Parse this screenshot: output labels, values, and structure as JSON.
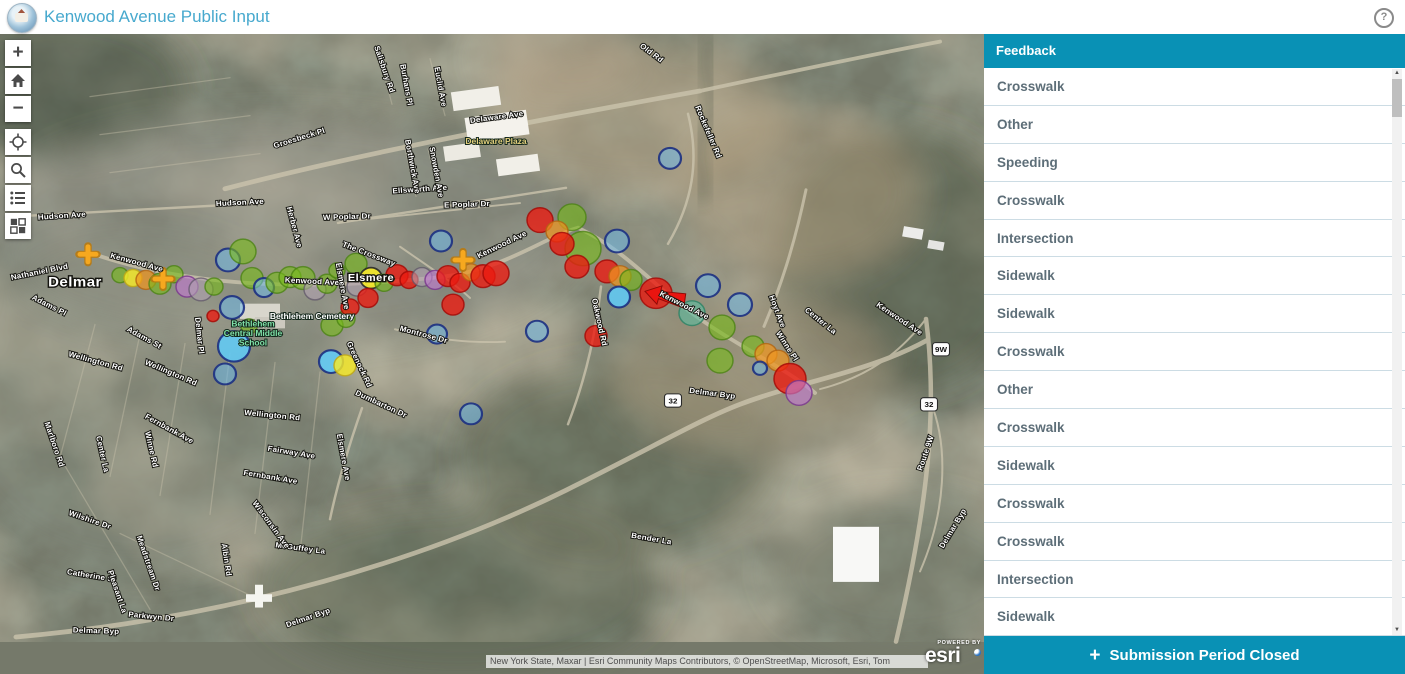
{
  "header": {
    "title": "Kenwood Avenue Public Input",
    "help": "?"
  },
  "panel": {
    "title": "Feedback",
    "items": [
      "Crosswalk",
      "Other",
      "Speeding",
      "Crosswalk",
      "Intersection",
      "Sidewalk",
      "Sidewalk",
      "Crosswalk",
      "Other",
      "Crosswalk",
      "Sidewalk",
      "Crosswalk",
      "Crosswalk",
      "Intersection",
      "Sidewalk"
    ],
    "footer_plus": "+",
    "footer_label": "Submission Period Closed"
  },
  "map": {
    "attribution": "New York State, Maxar | Esri Community Maps Contributors, © OpenStreetMap, Microsoft, Esri, Tom",
    "powered_by": "POWERED BY",
    "logo_text": "esri",
    "zoom_in_glyph": "+",
    "zoom_out_glyph": "−",
    "controls": [
      "zoom-in",
      "home",
      "zoom-out",
      "locate",
      "search",
      "legend",
      "basemap-gallery"
    ],
    "town_labels": [
      {
        "t": "Delmar",
        "x": 75,
        "y": 300
      },
      {
        "t": "Elsmere",
        "x": 371,
        "y": 294,
        "small": true
      }
    ],
    "poi_labels": [
      {
        "t": "Delaware Plaza",
        "x": 496,
        "y": 150,
        "c": "#e3cf7d"
      },
      {
        "t": "Bethlehem Cemetery",
        "x": 312,
        "y": 334,
        "c": "#ffffff"
      },
      {
        "t": "Bethlehem",
        "x": 253,
        "y": 342,
        "c": "#7fe0a8"
      },
      {
        "t": "Central Middle",
        "x": 253,
        "y": 352,
        "c": "#7fe0a8"
      },
      {
        "t": "School",
        "x": 253,
        "y": 362,
        "c": "#7fe0a8"
      }
    ],
    "road_labels": [
      {
        "t": "Hudson Ave",
        "x": 62,
        "y": 228,
        "r": -4
      },
      {
        "t": "Hudson Ave",
        "x": 240,
        "y": 214,
        "r": -3
      },
      {
        "t": "Nathaniel Blvd",
        "x": 40,
        "y": 287,
        "r": -12
      },
      {
        "t": "Kenwood Ave",
        "x": 136,
        "y": 277,
        "r": 16
      },
      {
        "t": "Kenwood Ave",
        "x": 312,
        "y": 297,
        "r": 3
      },
      {
        "t": "Kenwood Ave",
        "x": 503,
        "y": 258,
        "r": -27
      },
      {
        "t": "Kenwood Ave",
        "x": 683,
        "y": 322,
        "r": 28
      },
      {
        "t": "Kenwood Ave",
        "x": 898,
        "y": 336,
        "r": 35
      },
      {
        "t": "Delaware Ave",
        "x": 497,
        "y": 124,
        "r": -8
      },
      {
        "t": "Old Rd",
        "x": 650,
        "y": 56,
        "r": 38
      },
      {
        "t": "Rockefeller Rd",
        "x": 706,
        "y": 138,
        "r": 68
      },
      {
        "t": "Ellsworth Ave",
        "x": 420,
        "y": 200,
        "r": -4
      },
      {
        "t": "E Poplar Dr",
        "x": 467,
        "y": 216,
        "r": -2
      },
      {
        "t": "W Poplar Dr",
        "x": 347,
        "y": 229,
        "r": -2
      },
      {
        "t": "Euclid Ave",
        "x": 438,
        "y": 90,
        "r": 80
      },
      {
        "t": "Salisbury Rd",
        "x": 382,
        "y": 72,
        "r": 72
      },
      {
        "t": "Burhans Pl",
        "x": 404,
        "y": 88,
        "r": 80
      },
      {
        "t": "Groesbeck Pl",
        "x": 300,
        "y": 146,
        "r": -18
      },
      {
        "t": "Snowden Ave",
        "x": 434,
        "y": 180,
        "r": 80
      },
      {
        "t": "Borthwick Ave",
        "x": 410,
        "y": 174,
        "r": 80
      },
      {
        "t": "Herber Ave",
        "x": 292,
        "y": 238,
        "r": 76
      },
      {
        "t": "The Crossway",
        "x": 368,
        "y": 268,
        "r": 22
      },
      {
        "t": "Elsmere Ave",
        "x": 340,
        "y": 300,
        "r": 80
      },
      {
        "t": "Delmar Pl",
        "x": 197,
        "y": 352,
        "r": 84
      },
      {
        "t": "Adams Pl",
        "x": 48,
        "y": 322,
        "r": 28
      },
      {
        "t": "Adams St",
        "x": 143,
        "y": 356,
        "r": 30
      },
      {
        "t": "Wellington Rd",
        "x": 95,
        "y": 381,
        "r": 16
      },
      {
        "t": "Wellington Rd",
        "x": 170,
        "y": 393,
        "r": 24
      },
      {
        "t": "Wellington Rd",
        "x": 272,
        "y": 438,
        "r": 6
      },
      {
        "t": "Montrose Dr",
        "x": 423,
        "y": 353,
        "r": 16
      },
      {
        "t": "Greenock Rd",
        "x": 357,
        "y": 383,
        "r": 66
      },
      {
        "t": "Dumbarton Dr",
        "x": 380,
        "y": 426,
        "r": 26
      },
      {
        "t": "Oakwood Rd",
        "x": 597,
        "y": 338,
        "r": 78
      },
      {
        "t": "Fairway Ave",
        "x": 291,
        "y": 477,
        "r": 10
      },
      {
        "t": "Fernbank Ave",
        "x": 168,
        "y": 452,
        "r": 30
      },
      {
        "t": "Fernbank Ave",
        "x": 270,
        "y": 503,
        "r": 10
      },
      {
        "t": "Elsmere Ave",
        "x": 341,
        "y": 480,
        "r": 80
      },
      {
        "t": "Winne Rd",
        "x": 149,
        "y": 472,
        "r": 78
      },
      {
        "t": "Center La",
        "x": 100,
        "y": 477,
        "r": 78
      },
      {
        "t": "Marlboro Rd",
        "x": 52,
        "y": 467,
        "r": 72
      },
      {
        "t": "Wilshire Dr",
        "x": 89,
        "y": 548,
        "r": 20
      },
      {
        "t": "Catherine St",
        "x": 91,
        "y": 607,
        "r": 10
      },
      {
        "t": "Pleasant La",
        "x": 115,
        "y": 622,
        "r": 72
      },
      {
        "t": "Meadstream Dr",
        "x": 146,
        "y": 592,
        "r": 72
      },
      {
        "t": "Parkwyn Dr",
        "x": 151,
        "y": 650,
        "r": 6
      },
      {
        "t": "Albin Rd",
        "x": 224,
        "y": 588,
        "r": 82
      },
      {
        "t": "McGuffey La",
        "x": 300,
        "y": 578,
        "r": 8
      },
      {
        "t": "Wisconsin Ave",
        "x": 269,
        "y": 552,
        "r": 55
      },
      {
        "t": "Hoyt Ave",
        "x": 775,
        "y": 327,
        "r": 70
      },
      {
        "t": "Winne Pl",
        "x": 785,
        "y": 364,
        "r": 58
      },
      {
        "t": "Center La",
        "x": 819,
        "y": 338,
        "r": 40
      },
      {
        "t": "Bender La",
        "x": 651,
        "y": 568,
        "r": 10
      },
      {
        "t": "Delmar Byp",
        "x": 712,
        "y": 415,
        "r": 8
      },
      {
        "t": "Delmar Byp",
        "x": 96,
        "y": 665,
        "r": 2
      },
      {
        "t": "Delmar Byp",
        "x": 309,
        "y": 651,
        "r": -20
      },
      {
        "t": "Route 9W",
        "x": 928,
        "y": 476,
        "r": -72
      },
      {
        "t": "Delmar Byp",
        "x": 955,
        "y": 556,
        "r": -60
      }
    ],
    "shields": [
      {
        "t": "32",
        "x": 673,
        "y": 420
      },
      {
        "t": "32",
        "x": 929,
        "y": 424
      },
      {
        "t": "9W",
        "x": 941,
        "y": 366
      }
    ],
    "marker_styles": {
      "R": {
        "f": "rgba(236,25,16,0.78)",
        "s": "rgba(165,12,8,0.85)",
        "w": 1.5
      },
      "G": {
        "f": "rgba(120,186,28,0.62)",
        "s": "rgba(72,130,16,0.75)",
        "w": 1.5
      },
      "Y": {
        "f": "rgba(246,234,40,0.82)",
        "s": "rgba(190,168,22,0.85)",
        "w": 1.5
      },
      "Y2": {
        "f": "rgba(246,234,40,0.9)",
        "s": "rgba(40,40,40,0.9)",
        "w": 1.8
      },
      "B": {
        "f": "rgba(112,186,234,0.55)",
        "s": "rgba(28,48,130,0.9)",
        "w": 2.2
      },
      "C": {
        "f": "rgba(96,206,250,0.85)",
        "s": "rgba(28,48,130,0.9)",
        "w": 2.2
      },
      "O": {
        "f": "rgba(238,150,32,0.72)",
        "s": "rgba(178,100,16,0.8)",
        "w": 1.5
      },
      "P": {
        "f": "rgba(190,122,205,0.65)",
        "s": "rgba(120,52,140,0.8)",
        "w": 1.5
      },
      "Gy": {
        "f": "rgba(176,162,176,0.6)",
        "s": "rgba(92,82,102,0.7)",
        "w": 1.5
      },
      "T": {
        "f": "rgba(92,190,162,0.6)",
        "s": "rgba(42,130,100,0.8)",
        "w": 1.5
      }
    },
    "markers": [
      [
        120,
        288,
        8,
        "G"
      ],
      [
        133,
        291,
        9,
        "Y"
      ],
      [
        146,
        293,
        10,
        "O"
      ],
      [
        160,
        297,
        11,
        "G"
      ],
      [
        174,
        287,
        9,
        "G"
      ],
      [
        187,
        300,
        11,
        "P"
      ],
      [
        201,
        303,
        12,
        "Gy"
      ],
      [
        214,
        300,
        9,
        "G"
      ],
      [
        228,
        272,
        12,
        "B"
      ],
      [
        243,
        263,
        13,
        "G"
      ],
      [
        252,
        291,
        11,
        "G"
      ],
      [
        264,
        301,
        10,
        "B"
      ],
      [
        277,
        296,
        11,
        "G"
      ],
      [
        290,
        290,
        11,
        "G"
      ],
      [
        232,
        322,
        12,
        "B"
      ],
      [
        234,
        363,
        16,
        "C"
      ],
      [
        225,
        392,
        11,
        "B"
      ],
      [
        213,
        331,
        6,
        "R"
      ],
      [
        249,
        342,
        8,
        "G"
      ],
      [
        303,
        291,
        12,
        "G"
      ],
      [
        315,
        303,
        11,
        "Gy"
      ],
      [
        327,
        297,
        10,
        "G"
      ],
      [
        337,
        283,
        8,
        "G"
      ],
      [
        332,
        341,
        11,
        "G"
      ],
      [
        346,
        334,
        9,
        "G"
      ],
      [
        331,
        379,
        12,
        "C"
      ],
      [
        345,
        383,
        11,
        "Y"
      ],
      [
        356,
        276,
        11,
        "G"
      ],
      [
        357,
        300,
        10,
        "Gy"
      ],
      [
        371,
        291,
        11,
        "Y2"
      ],
      [
        384,
        296,
        9,
        "G"
      ],
      [
        368,
        312,
        10,
        "R"
      ],
      [
        350,
        322,
        9,
        "R"
      ],
      [
        397,
        288,
        11,
        "R"
      ],
      [
        409,
        293,
        9,
        "R"
      ],
      [
        422,
        290,
        10,
        "Gy"
      ],
      [
        435,
        293,
        10,
        "P"
      ],
      [
        448,
        289,
        11,
        "R"
      ],
      [
        460,
        296,
        10,
        "R"
      ],
      [
        471,
        285,
        9,
        "O"
      ],
      [
        483,
        289,
        12,
        "R"
      ],
      [
        496,
        286,
        13,
        "R"
      ],
      [
        453,
        319,
        11,
        "R"
      ],
      [
        441,
        252,
        11,
        "B"
      ],
      [
        437,
        350,
        10,
        "B"
      ],
      [
        471,
        434,
        11,
        "B"
      ],
      [
        540,
        230,
        13,
        "R"
      ],
      [
        572,
        227,
        14,
        "G"
      ],
      [
        557,
        242,
        11,
        "O"
      ],
      [
        583,
        260,
        18,
        "G"
      ],
      [
        562,
        255,
        12,
        "R"
      ],
      [
        617,
        252,
        12,
        "B"
      ],
      [
        577,
        279,
        12,
        "R"
      ],
      [
        607,
        284,
        12,
        "R"
      ],
      [
        620,
        289,
        11,
        "O"
      ],
      [
        631,
        293,
        11,
        "G"
      ],
      [
        596,
        352,
        11,
        "R"
      ],
      [
        537,
        347,
        11,
        "B"
      ],
      [
        656,
        307,
        16,
        "R"
      ],
      [
        619,
        311,
        11,
        "C"
      ],
      [
        708,
        299,
        12,
        "B"
      ],
      [
        740,
        319,
        12,
        "B"
      ],
      [
        692,
        328,
        13,
        "T"
      ],
      [
        722,
        343,
        13,
        "G"
      ],
      [
        753,
        363,
        11,
        "G"
      ],
      [
        766,
        371,
        11,
        "O"
      ],
      [
        778,
        378,
        11,
        "O"
      ],
      [
        720,
        378,
        13,
        "G"
      ],
      [
        760,
        386,
        7,
        "B"
      ],
      [
        790,
        397,
        16,
        "R"
      ],
      [
        799,
        412,
        13,
        "P"
      ],
      [
        670,
        165,
        11,
        "B"
      ]
    ],
    "plus_markers": [
      [
        88,
        266
      ],
      [
        163,
        292
      ],
      [
        463,
        272
      ]
    ],
    "arrow": {
      "x": 645,
      "y": 305,
      "angle": 15
    }
  },
  "colors": {
    "teal": "#0991b5",
    "title_blue": "#47a9ce",
    "item_text": "#5d6e78"
  }
}
